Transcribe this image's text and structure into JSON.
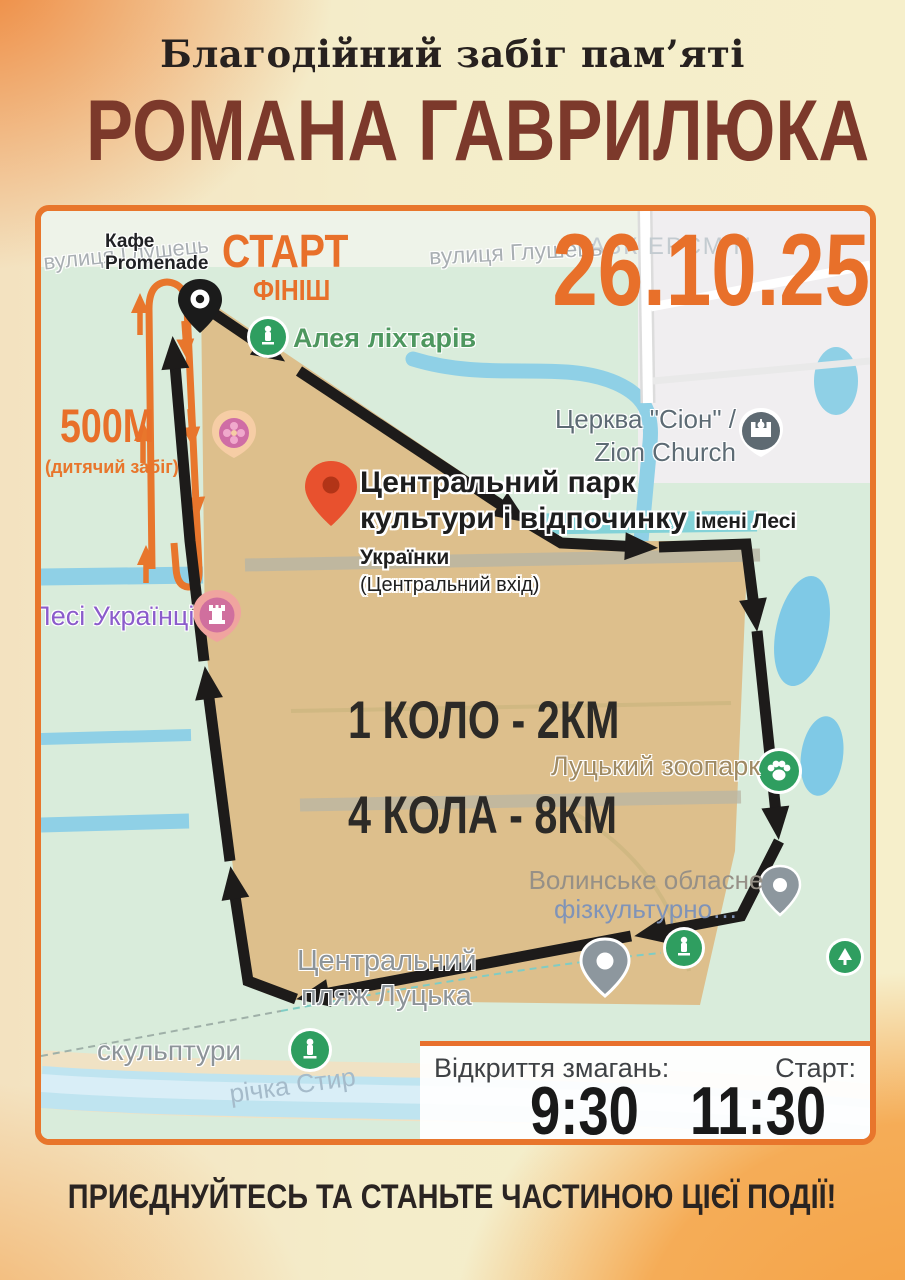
{
  "poster": {
    "title_small": "Благодійний забіг пам’яті",
    "title_big": "РОМАНА ГАВРИЛЮКА",
    "slogan": "ПРИЄДНУЙТЕСЬ ТА СТАНЬТЕ ЧАСТИНОЮ ЦІЄЇ ПОДІЇ!"
  },
  "event": {
    "date": "26.10.25",
    "start": "СТАРТ",
    "finish": "ФІНІШ",
    "kids_distance": "500М",
    "kids_note": "(дитячий забіг)",
    "lap_1": "1 КОЛО - 2КМ",
    "lap_4": "4 КОЛА - 8КМ",
    "opening_label": "Відкриття змагань:",
    "opening_time": "9:30",
    "start_time_label": "Старт:",
    "start_time": "11:30"
  },
  "map_labels": {
    "cafe_line1": "Кафе",
    "cafe_line2": "Promenade",
    "street_hlushets_left": "вулиця Глушець",
    "street_hlushets_center": "вулиця Глушець",
    "street_faint": "АЗК ЕРСМ Н",
    "alley": "Алея ліхтарів",
    "church_line1": "Церква \"Сіон\" /",
    "church_line2": "Zion Church",
    "park_line1": "Центральний парк",
    "park_line2": "культури і відпочинку",
    "park_line2_small": "імені Лесі Українки",
    "park_line3": "(Центральний вхід)",
    "lesi": "Лесі Українці",
    "zoo": "Луцький зоопарк",
    "volyn_line1": "Волинське обласне",
    "volyn_line2": "фізкультурно…",
    "beach_line1": "Центральний",
    "beach_line2": "пляж Луцька",
    "sculptures": "скульптури",
    "river": "річка Стир"
  },
  "icons": {
    "start_pin": "black-map-pin",
    "park_pin": "red-map-pin",
    "alley_icon": "green-attraction-circle",
    "church_icon": "slate-church-circle",
    "carousel_icon": "pink-amusement-marker",
    "monument_icon": "pink-castle-marker",
    "zoo_icon": "green-paw-circle",
    "sport_pin": "gray-map-pin",
    "beach_pin": "gray-map-pin",
    "statue_icons": "green-statue-circle",
    "tree_icon": "green-tree-circle"
  },
  "colors": {
    "accent_orange": "#E8702A",
    "title_maroon": "#7C392B",
    "park_tan": "#DDBF8C",
    "map_green": "#D9ECDB",
    "water_blue": "#8FD0E6",
    "route_black": "#1D1B1A"
  }
}
